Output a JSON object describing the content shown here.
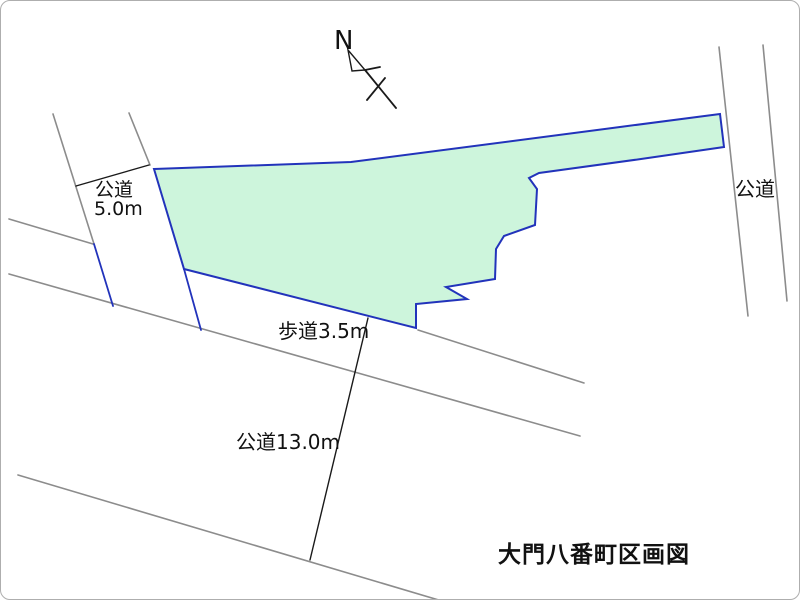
{
  "title": {
    "text": "大門八番町区画図"
  },
  "compass": {
    "label": "N"
  },
  "labels": {
    "left_road_line1": "公道",
    "left_road_line2": "5.0m",
    "sidewalk": "歩道3.5m",
    "bottom_road": "公道13.0m",
    "right_road": "公道"
  },
  "colors": {
    "parcel_fill": "#cdf5dc",
    "parcel_stroke": "#2233bb",
    "road_line": "#8c8c8c",
    "dimension_line": "#1a1a1a",
    "background": "#ffffff",
    "border": "#aeaeae"
  },
  "map": {
    "parcel_polygon": "153,168 350,161 719,113 723,146 640,158 538,172 528,177 536,188 534,224 503,235 495,248 494,278 445,286 466,298 415,303 415,327 183,268",
    "road_lines": [
      [
        52,
        113,
        93,
        243
      ],
      [
        128,
        112,
        149,
        164
      ],
      [
        8,
        218,
        92,
        243
      ],
      [
        8,
        273,
        579,
        435
      ],
      [
        417,
        329,
        583,
        382
      ],
      [
        17,
        474,
        441,
        600
      ],
      [
        718,
        46,
        747,
        315
      ],
      [
        762,
        44,
        786,
        300
      ]
    ],
    "road_edge_blue_segments": [
      [
        93,
        243,
        112,
        305
      ],
      [
        183,
        268,
        200,
        329
      ]
    ],
    "dimension_lines": [
      [
        75,
        185,
        148,
        164
      ],
      [
        367,
        317,
        309,
        559
      ]
    ],
    "compass": {
      "main_line": [
        364,
        69,
        395,
        107
      ],
      "tick_line": [
        364,
        69,
        379,
        66
      ],
      "cross_line": [
        384,
        77,
        366,
        99
      ],
      "arrow_polygon": "347,49 351,70 364,69"
    }
  }
}
